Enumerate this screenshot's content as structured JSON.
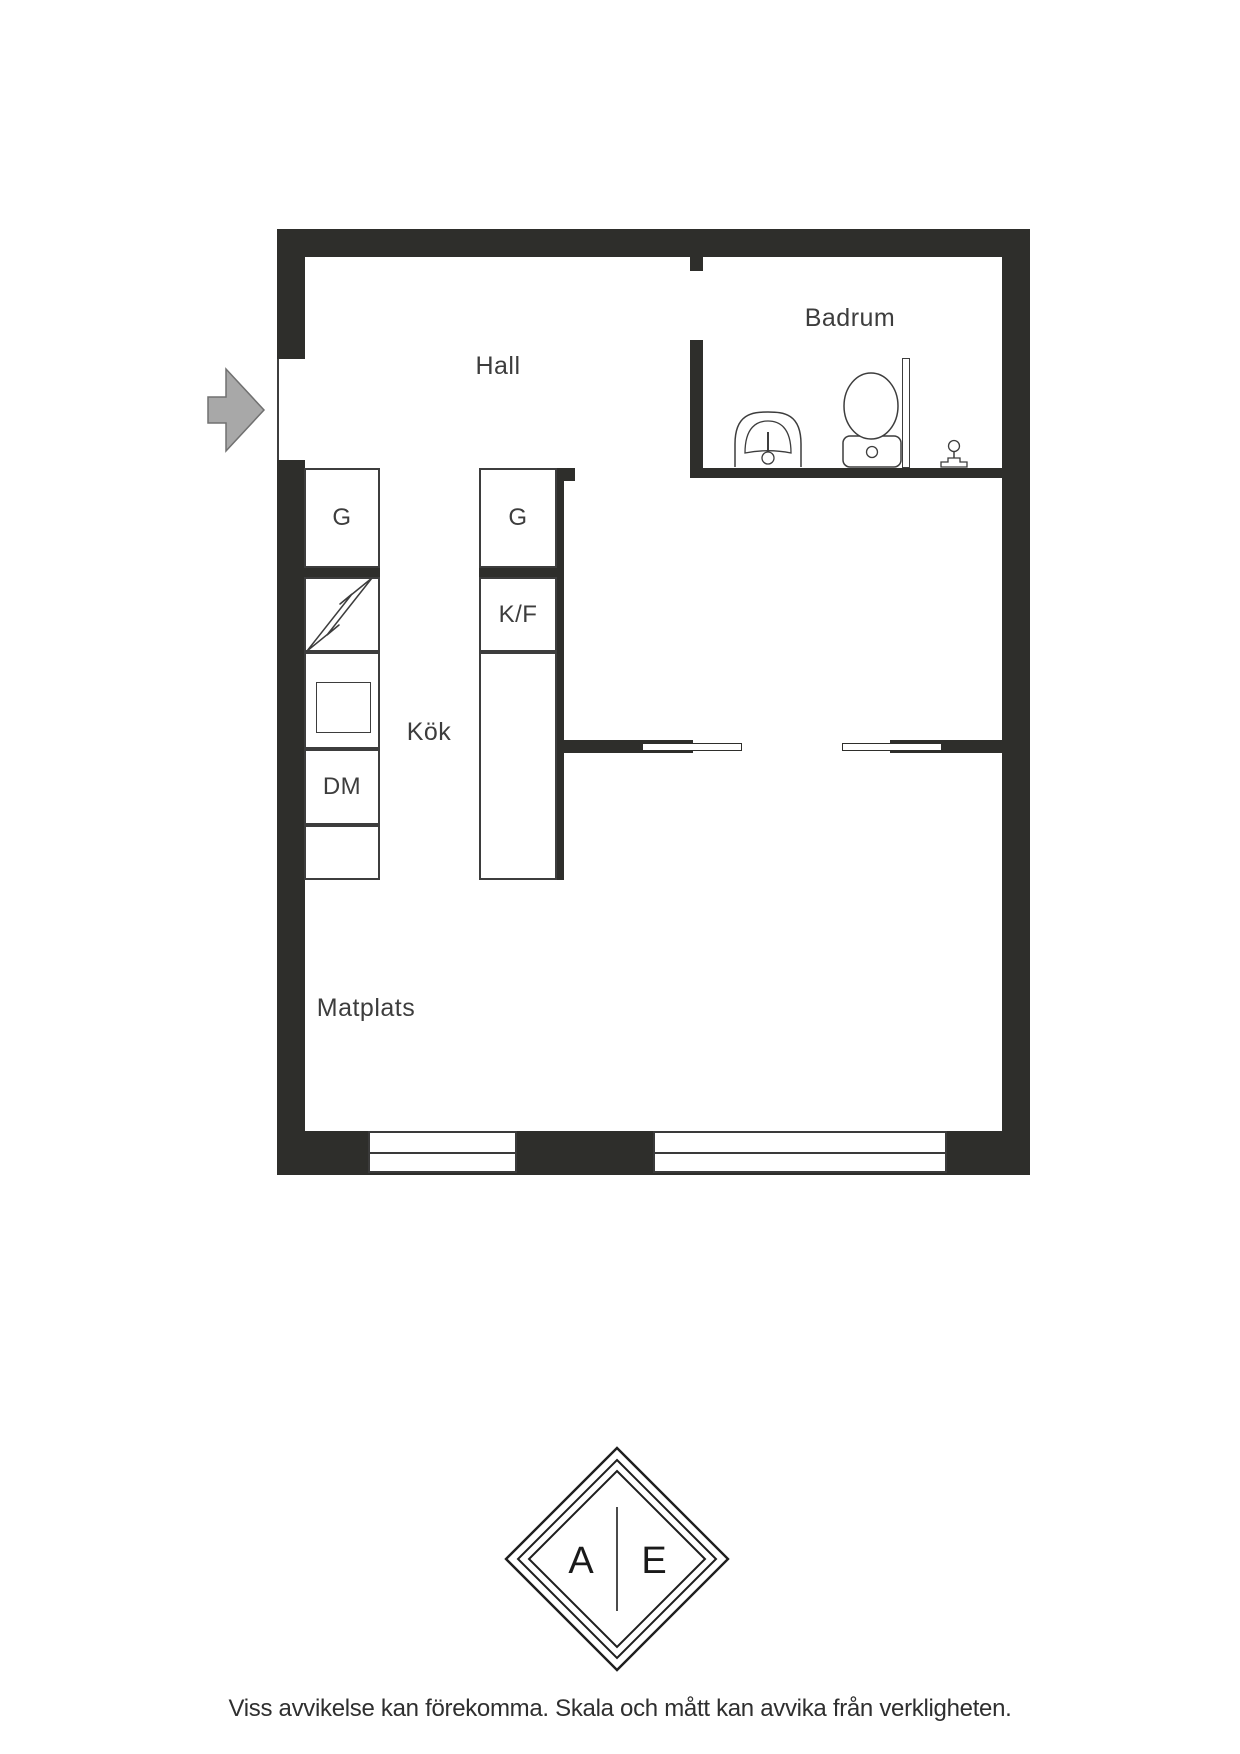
{
  "plan": {
    "rooms": [
      {
        "id": "hall",
        "label": "Hall"
      },
      {
        "id": "badrum",
        "label": "Badrum"
      },
      {
        "id": "kok",
        "label": "Kök"
      },
      {
        "id": "matplats",
        "label": "Matplats"
      }
    ],
    "cabinets": [
      {
        "id": "wardrobe-left",
        "label": "G"
      },
      {
        "id": "wardrobe-island",
        "label": "G"
      },
      {
        "id": "fridge-freezer",
        "label": "K/F"
      },
      {
        "id": "dishwasher",
        "label": "DM"
      }
    ],
    "icons": [
      "entrance-arrow-icon",
      "stove-lightning-icon",
      "sink-icon",
      "toilet-icon",
      "shower-glass-icon",
      "floor-drain-icon"
    ],
    "colors": {
      "wall": "#2e2e2b",
      "outline": "#3d3d3d",
      "arrow_fill": "#a8a8a8",
      "arrow_stroke": "#707070",
      "text": "#3d3d3d"
    }
  },
  "logo": {
    "left_letter": "A",
    "right_letter": "E"
  },
  "footer": {
    "disclaimer": "Viss avvikelse kan förekomma. Skala och mått kan avvika från verkligheten."
  }
}
